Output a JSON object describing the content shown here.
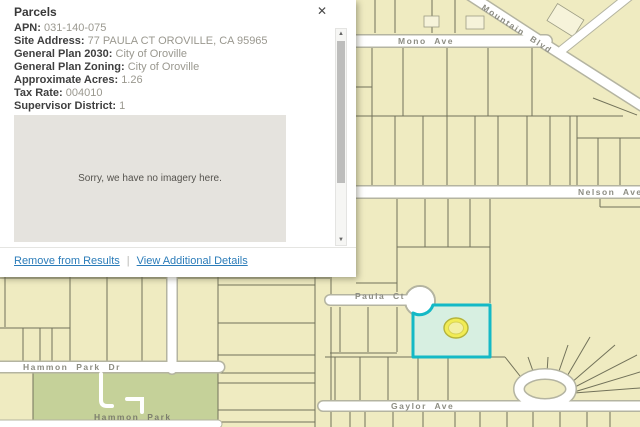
{
  "panel": {
    "title": "Parcels",
    "close_icon": "✕",
    "fields": [
      {
        "label": "APN:",
        "value": "031-140-075"
      },
      {
        "label": "Site Address:",
        "value": "77 PAULA CT OROVILLE, CA 95965"
      },
      {
        "label": "General Plan 2030:",
        "value": "City of Oroville"
      },
      {
        "label": "General Plan Zoning:",
        "value": "City of Oroville"
      },
      {
        "label": "Approximate Acres:",
        "value": "1.26"
      },
      {
        "label": "Tax Rate:",
        "value": "004010"
      },
      {
        "label": "Supervisor District:",
        "value": "1"
      }
    ],
    "imagery_placeholder": "Sorry, we have no imagery here.",
    "links": {
      "remove": "Remove from Results",
      "separator": "|",
      "details": "View Additional Details"
    },
    "scrollbar": {
      "up_icon": "▲",
      "down_icon": "▼"
    }
  },
  "map": {
    "street_labels": {
      "mono": "Mono Ave",
      "mountain": "Mountain Blvd",
      "nelson": "Nelson Ave",
      "paula": "Paula Ct",
      "hammon_dr": "Hammon Park Dr",
      "gaylor": "Gaylor Ave",
      "park": "Hammon Park"
    },
    "colors": {
      "map_background": "#efebc1",
      "parcel_line": "#72725a",
      "street_fill": "#ffffff",
      "street_casing": "#b4b4a1",
      "park_green": "#c5d199",
      "selected_outline": "#14b9c6",
      "selected_fill": "#d7efe1",
      "marker_yellow": "#f1ec55",
      "link_blue": "#2b7cb9"
    }
  }
}
